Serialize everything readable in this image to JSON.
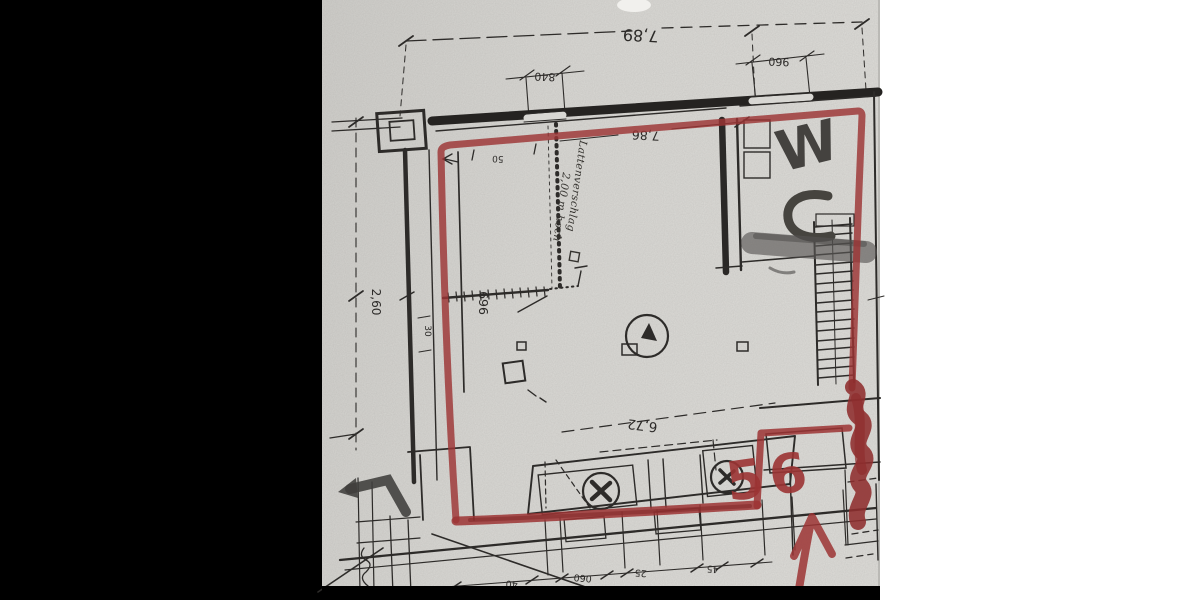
{
  "colors": {
    "paper": "#d8d7d3",
    "ink": "#2d2b29",
    "red_marker": "#9c3434",
    "gray_marker": "#4f4d4a",
    "left_bar": "#000000",
    "right_field": "#ffffff"
  },
  "plan": {
    "dims": {
      "overall_top": "7,89",
      "opening_a": "840",
      "opening_b": "960",
      "inner_top": "7,86",
      "inner_bottom": "6,72",
      "left_lower": "2,60",
      "left_upper": "696",
      "partition_depth": "30",
      "partition_opening": "50",
      "bottom_a": "40",
      "bottom_b": "060",
      "bottom_c": "25",
      "bottom_d": "45"
    },
    "labels": {
      "wc_w": "W",
      "wc_full": "WC",
      "note_line1": "Lattenverschlag",
      "note_line2": "2,00 m hoch"
    },
    "red_annotations": {
      "number": "56"
    }
  }
}
